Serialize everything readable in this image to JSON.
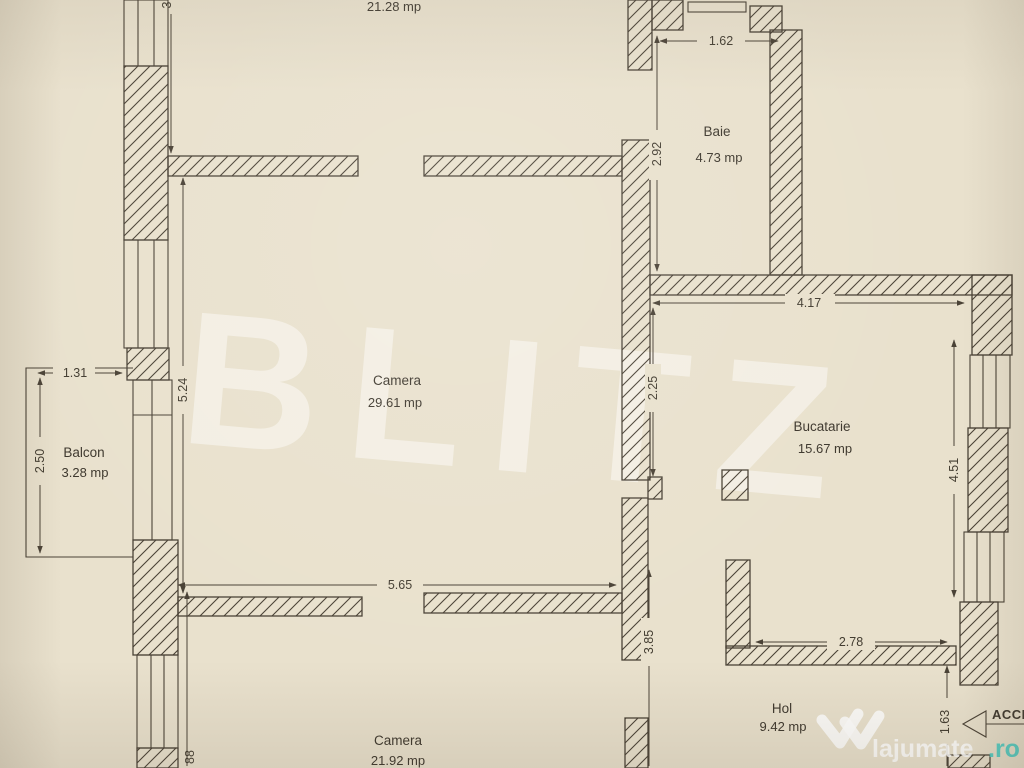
{
  "rooms": {
    "camera_top": {
      "area": "21.28 mp"
    },
    "baie": {
      "name": "Baie",
      "area": "4.73 mp"
    },
    "camera_mid": {
      "name": "Camera",
      "area": "29.61 mp"
    },
    "bucatarie": {
      "name": "Bucatarie",
      "area": "15.67 mp"
    },
    "balcon": {
      "name": "Balcon",
      "area": "3.28 mp"
    },
    "camera_bottom": {
      "name": "Camera",
      "area": "21.92 mp"
    },
    "hol": {
      "name": "Hol",
      "area": "9.42 mp"
    }
  },
  "dimensions": {
    "baie_width": "1.62",
    "baie_height": "2.92",
    "bucatarie_width": "4.17",
    "bucatarie_left_height": "2.25",
    "bucatarie_right_height": "4.51",
    "bucatarie_bottom_width": "2.78",
    "camera_mid_height": "5.24",
    "camera_mid_width": "5.65",
    "hol_wall_height": "3.85",
    "balcon_width": "1.31",
    "balcon_height": "2.50",
    "top_left_partial": "3",
    "bottom_left_partial": "88",
    "access_height": "1.63"
  },
  "labels": {
    "access": "ACCES"
  },
  "watermarks": {
    "brand": "BLITZ",
    "site_name": "lajumate",
    "site_tld": ".ro"
  },
  "colors": {
    "paper": "#e9e1cd",
    "line": "#4a4236",
    "teal": "#48cdc4",
    "watermark": "rgba(255,255,255,0.45)"
  }
}
